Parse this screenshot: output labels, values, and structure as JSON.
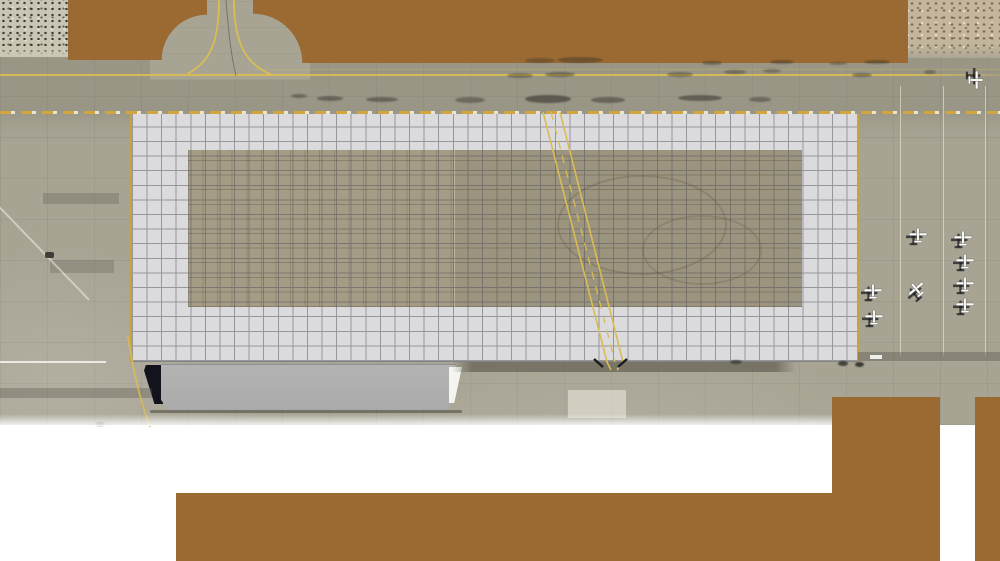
{
  "colors": {
    "background": "#FFFFFF",
    "pavement": "#A8A494",
    "brown": "#9B6A33",
    "grid_bg": "#DBDBDD",
    "grid_line": "#54545E",
    "tan": "#A49C85",
    "yellow": "#D9BC55",
    "dash_gold": "#D2A53E",
    "dash_cream": "#EAE5D1",
    "hangar": "#ABABAB",
    "desert_left_base": "#C9C5B4",
    "desert_right_base": "#C3B69C",
    "shadow_dark": "#13131E"
  },
  "airfield": {
    "planes": [
      {
        "x": 975,
        "y": 80,
        "rot": 90
      },
      {
        "x": 918,
        "y": 236,
        "rot": 0
      },
      {
        "x": 963,
        "y": 239,
        "rot": 0
      },
      {
        "x": 965,
        "y": 262,
        "rot": 0
      },
      {
        "x": 873,
        "y": 292,
        "rot": 0
      },
      {
        "x": 917,
        "y": 290,
        "rot": -40
      },
      {
        "x": 965,
        "y": 285,
        "rot": 0
      },
      {
        "x": 965,
        "y": 306,
        "rot": 0
      },
      {
        "x": 874,
        "y": 318,
        "rot": 0
      }
    ],
    "tie_down_line_xs": [
      900,
      943,
      985
    ],
    "tire_marks": [
      {
        "x": 299,
        "y": 96,
        "w": 16,
        "h": 4,
        "o": 0.4
      },
      {
        "x": 330,
        "y": 98,
        "w": 26,
        "h": 5,
        "o": 0.45
      },
      {
        "x": 382,
        "y": 99,
        "w": 32,
        "h": 5,
        "o": 0.45
      },
      {
        "x": 470,
        "y": 100,
        "w": 30,
        "h": 6,
        "o": 0.4
      },
      {
        "x": 548,
        "y": 99,
        "w": 46,
        "h": 8,
        "o": 0.55
      },
      {
        "x": 608,
        "y": 100,
        "w": 34,
        "h": 6,
        "o": 0.45
      },
      {
        "x": 700,
        "y": 98,
        "w": 44,
        "h": 6,
        "o": 0.5
      },
      {
        "x": 760,
        "y": 99,
        "w": 22,
        "h": 5,
        "o": 0.4
      },
      {
        "x": 520,
        "y": 75,
        "w": 26,
        "h": 5,
        "o": 0.38
      },
      {
        "x": 560,
        "y": 74,
        "w": 30,
        "h": 5,
        "o": 0.42
      },
      {
        "x": 680,
        "y": 74,
        "w": 26,
        "h": 5,
        "o": 0.38
      },
      {
        "x": 735,
        "y": 72,
        "w": 22,
        "h": 4,
        "o": 0.38
      },
      {
        "x": 772,
        "y": 71,
        "w": 18,
        "h": 4,
        "o": 0.33
      },
      {
        "x": 862,
        "y": 75,
        "w": 20,
        "h": 4,
        "o": 0.42
      },
      {
        "x": 930,
        "y": 72,
        "w": 12,
        "h": 4,
        "o": 0.38
      },
      {
        "x": 712,
        "y": 63,
        "w": 20,
        "h": 4,
        "o": 0.38
      },
      {
        "x": 782,
        "y": 62,
        "w": 24,
        "h": 4,
        "o": 0.38
      },
      {
        "x": 838,
        "y": 63,
        "w": 18,
        "h": 3,
        "o": 0.33
      },
      {
        "x": 877,
        "y": 62,
        "w": 26,
        "h": 4,
        "o": 0.38
      },
      {
        "x": 540,
        "y": 60,
        "w": 30,
        "h": 5,
        "o": 0.33
      },
      {
        "x": 580,
        "y": 60,
        "w": 46,
        "h": 6,
        "o": 0.38
      },
      {
        "x": 843,
        "y": 363,
        "w": 10,
        "h": 5,
        "o": 0.8
      },
      {
        "x": 859,
        "y": 364,
        "w": 9,
        "h": 5,
        "o": 0.85
      },
      {
        "x": 736,
        "y": 362,
        "w": 12,
        "h": 4,
        "o": 0.6
      },
      {
        "x": 100,
        "y": 424,
        "w": 10,
        "h": 4,
        "o": 0.6
      }
    ]
  }
}
